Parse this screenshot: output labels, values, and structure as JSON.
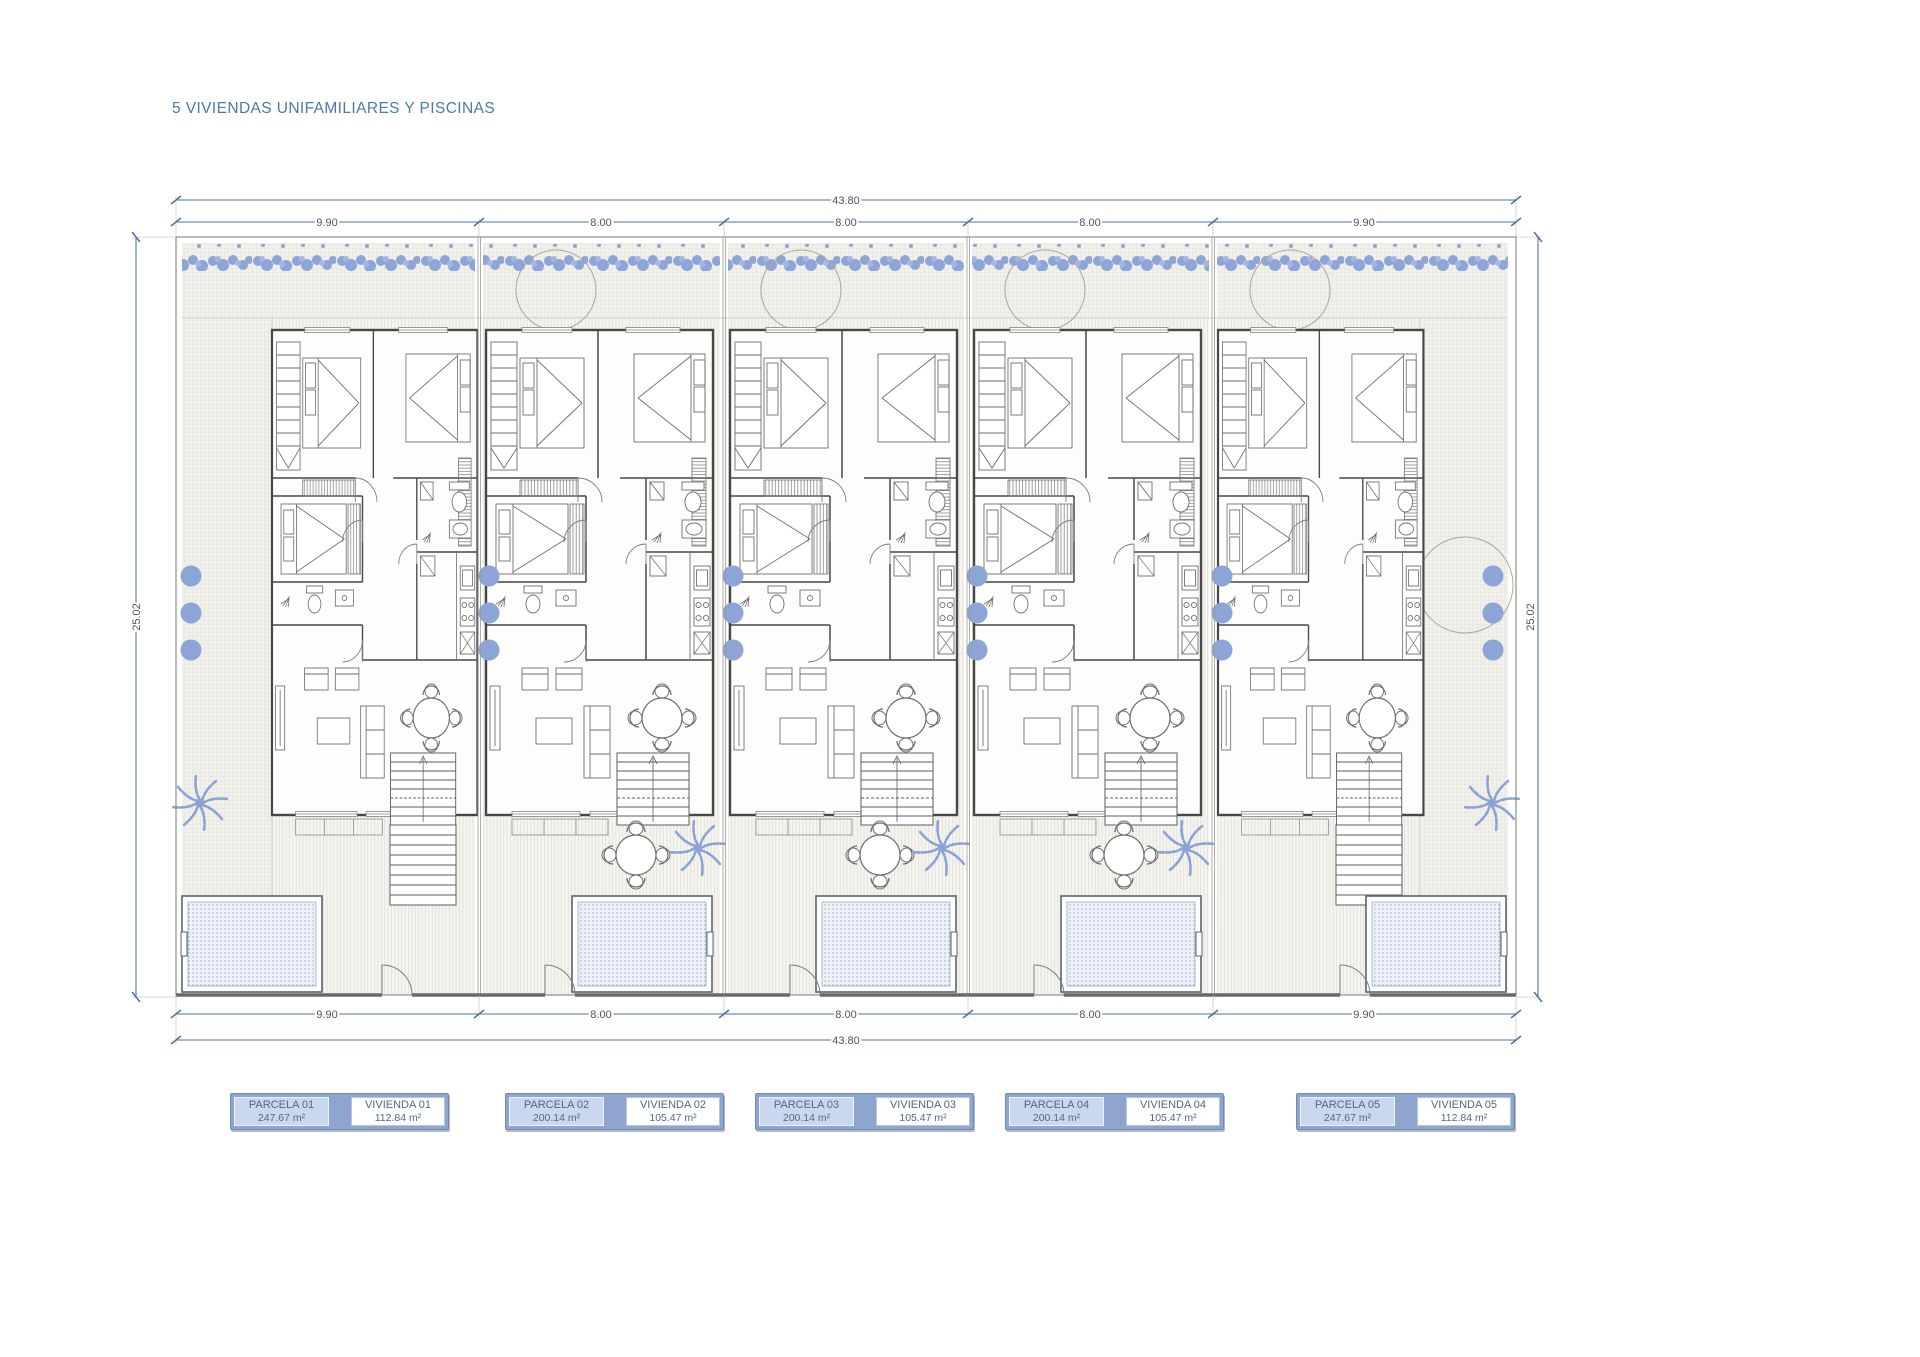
{
  "title": "5 VIVIENDAS UNIFAMILIARES Y PISCINAS",
  "dimensions": {
    "top_total": "43.80",
    "bottom_total": "43.80",
    "left_side": "25.02",
    "right_side": "25.02",
    "top_segments": [
      "9.90",
      "8.00",
      "8.00",
      "8.00",
      "9.90"
    ],
    "bottom_segments": [
      "9.90",
      "8.00",
      "8.00",
      "8.00",
      "9.90"
    ]
  },
  "parcels": [
    {
      "parcela_label": "PARCELA 01",
      "parcela_area": "247.67 m²",
      "vivienda_label": "VIVIENDA 01",
      "vivienda_area": "112.84 m²"
    },
    {
      "parcela_label": "PARCELA 02",
      "parcela_area": "200.14 m²",
      "vivienda_label": "VIVIENDA 02",
      "vivienda_area": "105.47 m²"
    },
    {
      "parcela_label": "PARCELA 03",
      "parcela_area": "200.14 m²",
      "vivienda_label": "VIVIENDA 03",
      "vivienda_area": "105.47 m²"
    },
    {
      "parcela_label": "PARCELA 04",
      "parcela_area": "200.14 m²",
      "vivienda_label": "VIVIENDA 04",
      "vivienda_area": "105.47 m²"
    },
    {
      "parcela_label": "PARCELA 05",
      "parcela_area": "247.67 m²",
      "vivienda_label": "VIVIENDA 05",
      "vivienda_area": "112.84 m²"
    }
  ],
  "icons": {
    "palm": "palm-tree-icon",
    "bush": "bush-icon",
    "tree": "tree-canopy-icon",
    "hedge": "hedge-icon",
    "pool": "swimming-pool",
    "dining": "dining-set-icon"
  },
  "colors": {
    "title_text": "#4c7aa6",
    "dimension_line": "#52719f",
    "dimension_text": "#4a5563",
    "landscape_blue": "#8ca4d6",
    "wall_line": "#474747",
    "plan_line": "#6e6e6e",
    "table_frame": "#8ea6cf",
    "parcela_cell_fill": "#c9d8ee",
    "vivienda_cell_fill": "#ffffff",
    "table_text": "#4f6687",
    "pool_water": "#edf1f7"
  }
}
